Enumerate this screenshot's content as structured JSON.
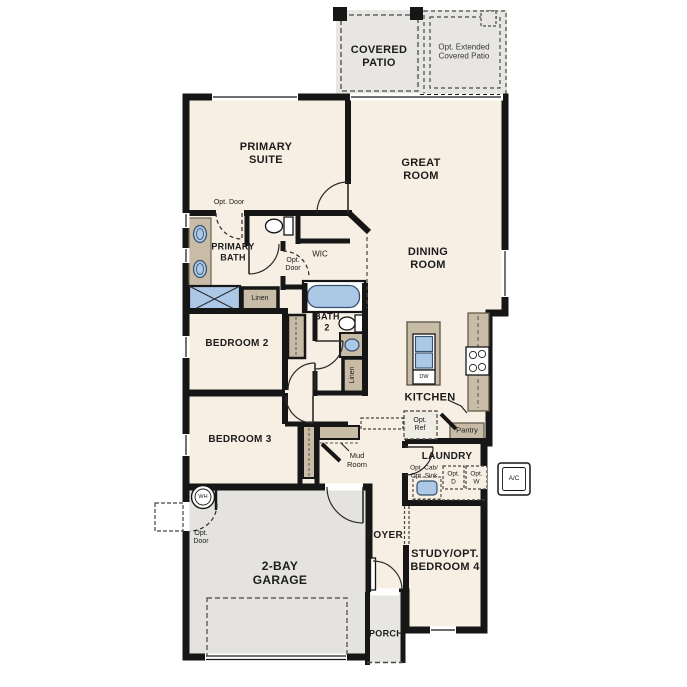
{
  "plan": {
    "colors": {
      "floor": "#f7efe3",
      "patio": "#e7e6e2",
      "garage": "#e4e3e0",
      "wall": "#161616",
      "cabinet": "#c9bca7",
      "fixture_blue": "#abc8e6"
    },
    "rooms": {
      "covered_patio": {
        "line1": "COVERED",
        "line2": "PATIO"
      },
      "opt_extended_patio": {
        "line1": "Opt. Extended",
        "line2": "Covered Patio"
      },
      "primary_suite": {
        "line1": "PRIMARY",
        "line2": "SUITE"
      },
      "great_room": {
        "line1": "GREAT",
        "line2": "ROOM"
      },
      "primary_bath": {
        "line1": "PRIMARY",
        "line2": "BATH"
      },
      "wic": {
        "label": "WIC"
      },
      "dining_room": {
        "line1": "DINING",
        "line2": "ROOM"
      },
      "bath_2": {
        "line1": "BATH",
        "line2": "2"
      },
      "bedroom_2": {
        "label": "BEDROOM 2"
      },
      "kitchen": {
        "label": "KITCHEN"
      },
      "bedroom_3": {
        "label": "BEDROOM 3"
      },
      "laundry": {
        "label": "LAUNDRY"
      },
      "mud_room": {
        "line1": "Mud",
        "line2": "Room"
      },
      "foyer": {
        "label": "FOYER"
      },
      "garage": {
        "line1": "2-BAY",
        "line2": "GARAGE"
      },
      "study": {
        "line1": "STUDY/OPT.",
        "line2": "BEDROOM 4"
      },
      "porch": {
        "label": "PORCH"
      }
    },
    "annotations": {
      "opt_door_inline": "Opt. Door",
      "opt_door": {
        "line1": "Opt.",
        "line2": "Door"
      },
      "linen": "Linen",
      "pantry": "Pantry",
      "opt_ref": {
        "line1": "Opt.",
        "line2": "Ref"
      },
      "opt_cab_sink": {
        "line1": "Opt. Cab/",
        "line2": "Opt. Sink"
      },
      "opt_d": {
        "line1": "Opt.",
        "line2": "D"
      },
      "opt_w": {
        "line1": "Opt.",
        "line2": "W"
      },
      "ac": "A/C",
      "wh": "WH",
      "dw": "DW"
    }
  }
}
